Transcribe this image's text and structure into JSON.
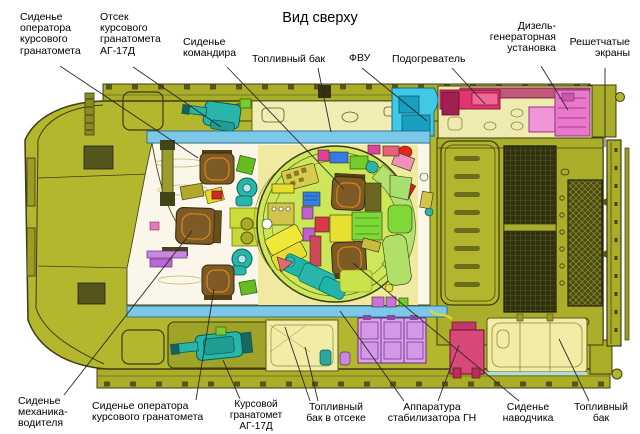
{
  "title": "Вид сверху",
  "labels": [
    {
      "id": "seat-operator-front-top",
      "text": "Сиденье\nоператора\nкурсового\nгранатомета"
    },
    {
      "id": "bay-course-launcher",
      "text": "Отсек\nкурсового\nгранатомета\nАГ-17Д"
    },
    {
      "id": "commander-seat",
      "text": "Сиденье\nкомандира"
    },
    {
      "id": "fuel-tank-top",
      "text": "Топливный бак"
    },
    {
      "id": "fvu",
      "text": "ФВУ"
    },
    {
      "id": "heater",
      "text": "Подогреватель"
    },
    {
      "id": "diesel-generator",
      "text": "Дизель-\nгенераторная\nустановка"
    },
    {
      "id": "lattice-screens",
      "text": "Решетчатые\nэкраны"
    },
    {
      "id": "driver-seat",
      "text": "Сиденье\nмеханика-\nводителя"
    },
    {
      "id": "seat-operator-front-bottom",
      "text": "Сиденье оператора\nкурсового гранатомета"
    },
    {
      "id": "course-launcher",
      "text": "Курсовой\nгранатомет\nАГ-17Д"
    },
    {
      "id": "fuel-tank-bay",
      "text": "Топливный\nбак в отсеке"
    },
    {
      "id": "stabilizer-equipment",
      "text": "Аппаратура\nстабилизатора ГН"
    },
    {
      "id": "gunner-seat",
      "text": "Сиденье\nнаводчика"
    },
    {
      "id": "fuel-tank-right",
      "text": "Топливный\nбак"
    }
  ],
  "colors": {
    "hull_olive": "#b3b72e",
    "deck_olive": "#a9ad28",
    "outline": "#3c3c14",
    "cyan_band": "#7cc8e8",
    "teal_equipment": "#28b6aa",
    "fvu_cyan": "#40c8e4",
    "heater_magenta": "#e0356e",
    "diesel_pink": "#ee82d8",
    "rose_bar": "#c05878",
    "seat_brown": "#7d5a26",
    "seat_trim_orange": "#d8881a",
    "turret_green": "#cde65a",
    "pale_floor": "#efeaa0",
    "white_floor": "#faf7ea",
    "fuel_tank_pale": "#f2eda6",
    "fuel_tank_violet": "#dca2ec",
    "stabilizer_crimson": "#d84878",
    "grille_dark": "#2f3110"
  }
}
